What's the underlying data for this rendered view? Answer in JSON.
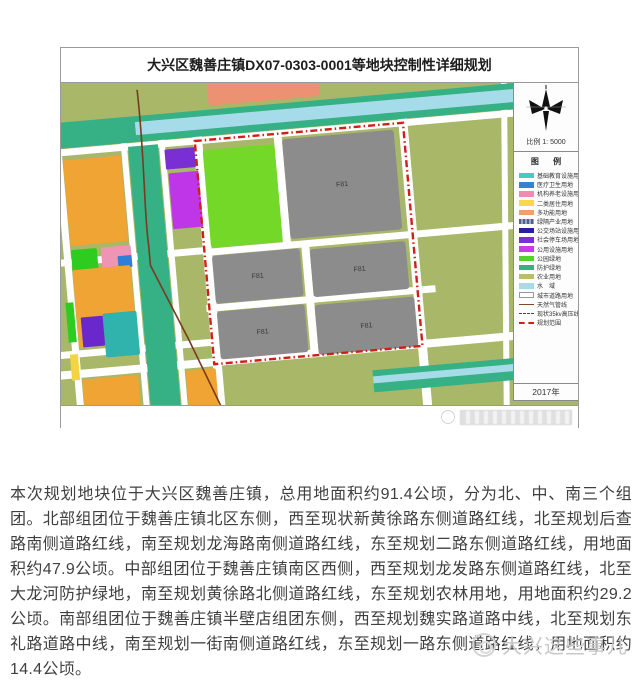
{
  "figure": {
    "title": "大兴区魏善庄镇DX07-0303-0001等地块控制性详细规划",
    "scale_label": "比例 1: 5000",
    "legend_title": "图 例",
    "year": "2017年",
    "block_labels": [
      "F81",
      "F81",
      "F81",
      "F81",
      "F81"
    ],
    "legend": {
      "items": [
        {
          "label": "基础教育设施用地",
          "type": "fill",
          "color": "#4cc8c4"
        },
        {
          "label": "医疗卫生用地",
          "type": "fill",
          "color": "#3a7fd0"
        },
        {
          "label": "机构养老设施用地",
          "type": "fill",
          "color": "#f08cb4"
        },
        {
          "label": "二类居住用地",
          "type": "fill",
          "color": "#f6d84f"
        },
        {
          "label": "多功能用地",
          "type": "fill",
          "color": "#f0a070"
        },
        {
          "label": "绿隔产业用地",
          "type": "hatch",
          "color": "#55608a"
        },
        {
          "label": "公交场站设施用地",
          "type": "fill",
          "color": "#2b1f9e"
        },
        {
          "label": "社会停车场用地",
          "type": "fill",
          "color": "#7b2fd6"
        },
        {
          "label": "公用设施用地",
          "type": "fill",
          "color": "#c93ae8"
        },
        {
          "label": "公园绿地",
          "type": "fill",
          "color": "#52d228"
        },
        {
          "label": "防护绿地",
          "type": "fill",
          "color": "#35b184"
        },
        {
          "label": "农业用地",
          "type": "fill",
          "color": "#b9bd6d"
        },
        {
          "label": "水　域",
          "type": "fill",
          "color": "#a6dbe9"
        },
        {
          "label": "城市道路用地",
          "type": "road",
          "color": "#ffffff"
        },
        {
          "label": "天然气管线",
          "type": "line",
          "color": "#7a4a2a"
        },
        {
          "label": "现状35kv高压线",
          "type": "dashline",
          "color": "#444444"
        },
        {
          "label": "规划范围",
          "type": "boundary",
          "color": "#cf1f16"
        }
      ]
    },
    "map_colors": {
      "farmland": "#a8b768",
      "park_green": "#74d829",
      "industry_gray": "#8c8c8c",
      "residential_orange": "#f0a433",
      "protective_green": "#36b085",
      "water_blue": "#a6dbe9",
      "boundary_red": "#cf1f16",
      "pipeline_brown": "#7a3a20"
    }
  },
  "body": {
    "paragraph": "本次规划地块位于大兴区魏善庄镇，总用地面积约91.4公顷，分为北、中、南三个组团。北部组团位于魏善庄镇北区东侧，西至现状新黄徐路东侧道路红线，北至规划后查路南侧道路红线，南至规划龙海路南侧道路红线，东至规划二路东侧道路红线，用地面积约47.9公顷。中部组团位于魏善庄镇南区西侧，西至规划龙发路东侧道路红线，北至大龙河防护绿地，南至规划黄徐路北侧道路红线，东至规划农林用地，用地面积约29.2公顷。南部组团位于魏善庄镇半壁店组团东侧，西至规划魏实路道路中线，北至规划东礼路道路中线，南至规划一街南侧道路红线，东至规划一路东侧道路红线，用地面积约14.4公顷。"
  },
  "footer": {
    "watermark": "大兴这些事儿"
  }
}
